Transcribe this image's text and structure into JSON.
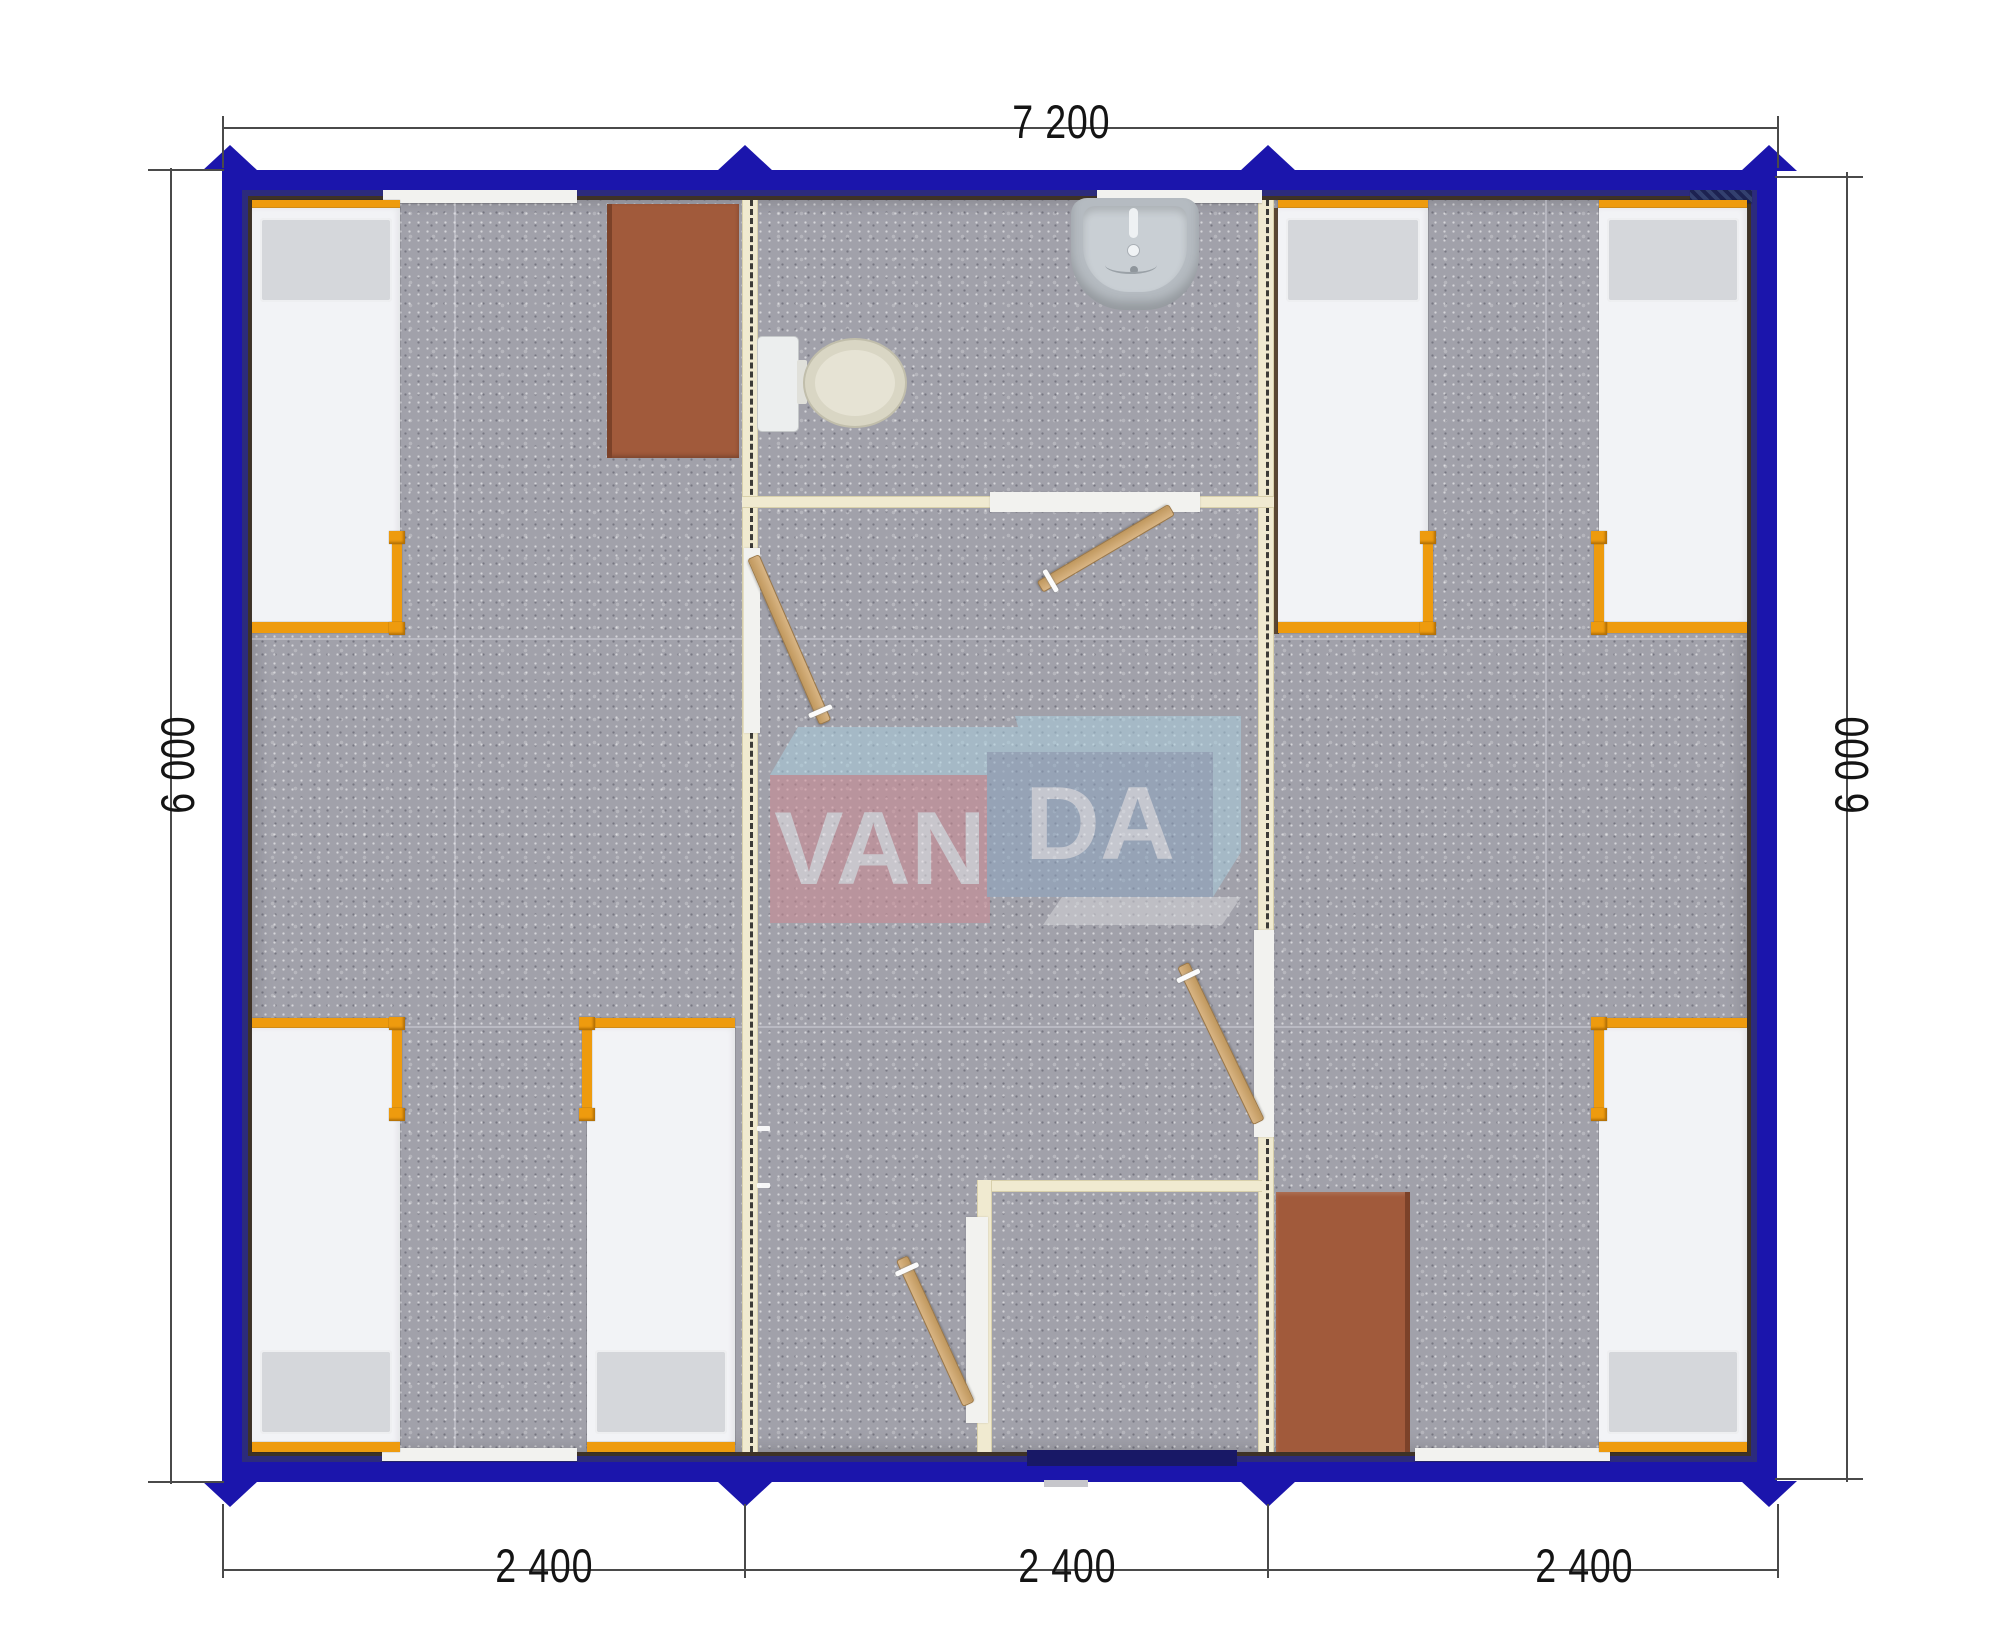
{
  "annotations": {
    "total_width": "7 200",
    "side_height": "6 000",
    "segment_widths": [
      "2 400",
      "2 400",
      "2 400"
    ]
  },
  "logo": {
    "left_text": "VAN",
    "right_text": "DA"
  },
  "colors": {
    "wallBlue": "#1b15ac",
    "wallNavy": "#2c2b7c",
    "wallEdge": "#3e3226",
    "partition": "#f0ead0",
    "partitionEdge": "#d8d0ab",
    "dashLine": "#1c1c1c",
    "carpet": "#a1a1aa",
    "bedWhite": "#f2f3f6",
    "pillowGray": "#d5d7db",
    "orange": "#ee9b0e",
    "woodDoorEdge": "#9d7845",
    "tableBrown": "#a15a3b",
    "tableEdge": "#7c4229",
    "toiletBeige": "#d9d6c4",
    "fixtureGray": "#b5bbc1",
    "fixtureLight": "#c9cfd4",
    "windowWhite": "#f2f2ef",
    "entryDark": "#181866",
    "stepGray": "#c6c6cb",
    "logoRed": "#cd8a93",
    "logoBlue": "#8ea6c1",
    "logoSky": "#a9cede",
    "logoGray": "#d6d7db",
    "logoText": "#edeff3",
    "dimLine": "#4a4a4a",
    "dimText": "#141414"
  }
}
